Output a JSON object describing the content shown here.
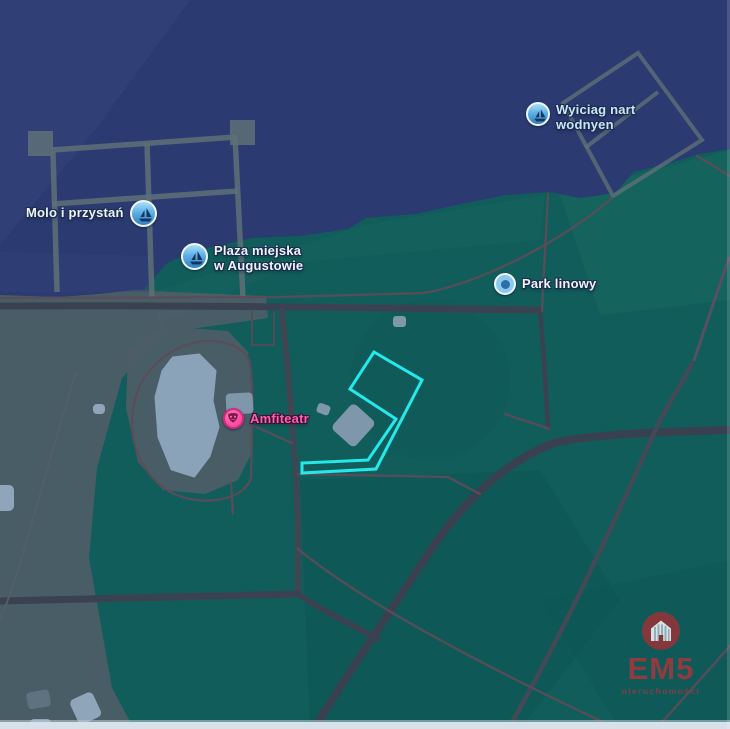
{
  "pois": {
    "molo": {
      "label": "Molo i przystań",
      "icon": "sailboat-icon"
    },
    "plaza": {
      "line1": "Plaza miejska",
      "line2": "w Augustowie",
      "icon": "sailboat-icon"
    },
    "wyciag": {
      "line1": "Wyiciag nart",
      "line2": "wodnyen",
      "icon": "sailboat-icon"
    },
    "park_linowy": {
      "label": "Park linowy",
      "icon": "poi-dot-icon"
    },
    "amfiteatr": {
      "label": "Amfiteatr",
      "icon": "theater-mask-icon"
    }
  },
  "watermark": {
    "brand": "EM5",
    "tagline": "nieruchomości"
  },
  "colors": {
    "water": "#2b3a71",
    "land_teal": "#115d5b",
    "land_gray": "#4c5e67",
    "road": "#3a4251",
    "path": "#5c4c58",
    "highlight_outline": "#25e8ea",
    "poi_label": "#ecf4f8",
    "wyciag_label": "#c9e6f4",
    "amfiteatr_label": "#ff5fae",
    "brand_red": "#9c393e"
  }
}
